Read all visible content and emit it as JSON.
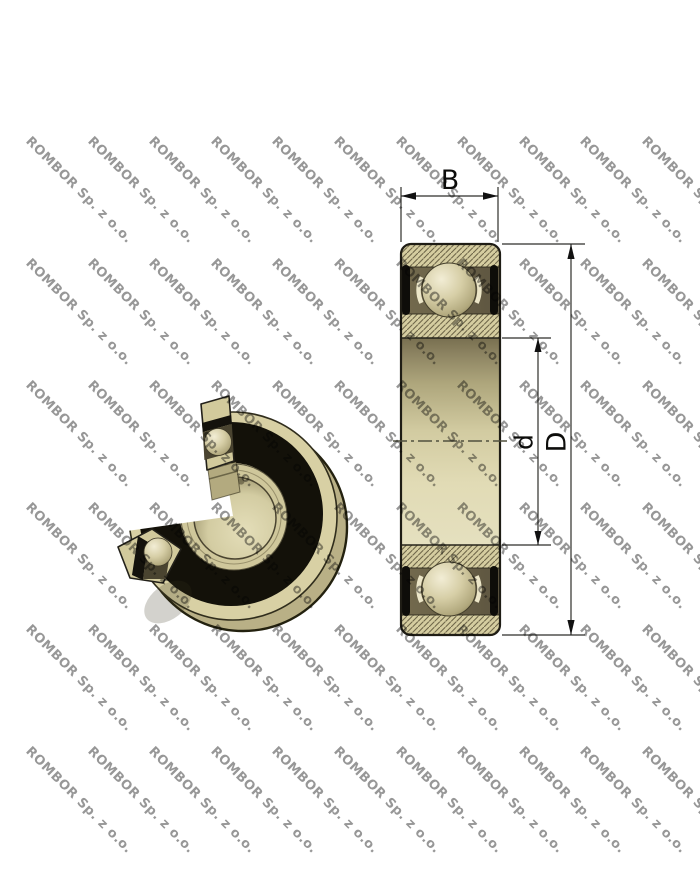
{
  "watermark": {
    "text": "ROMBOR Sp. z o.o.",
    "color": "#8f8f8f"
  },
  "section_view": {
    "labels": {
      "width": "B",
      "outer_diameter": "D",
      "bore_diameter": "d"
    }
  },
  "palette": {
    "bearing_tan": "#d5cda0",
    "bearing_tan_dark": "#6b6248",
    "seal_black": "#14120c",
    "dimension_line": "#2e2e2a",
    "watermark_gray": "#8f8f8f"
  }
}
